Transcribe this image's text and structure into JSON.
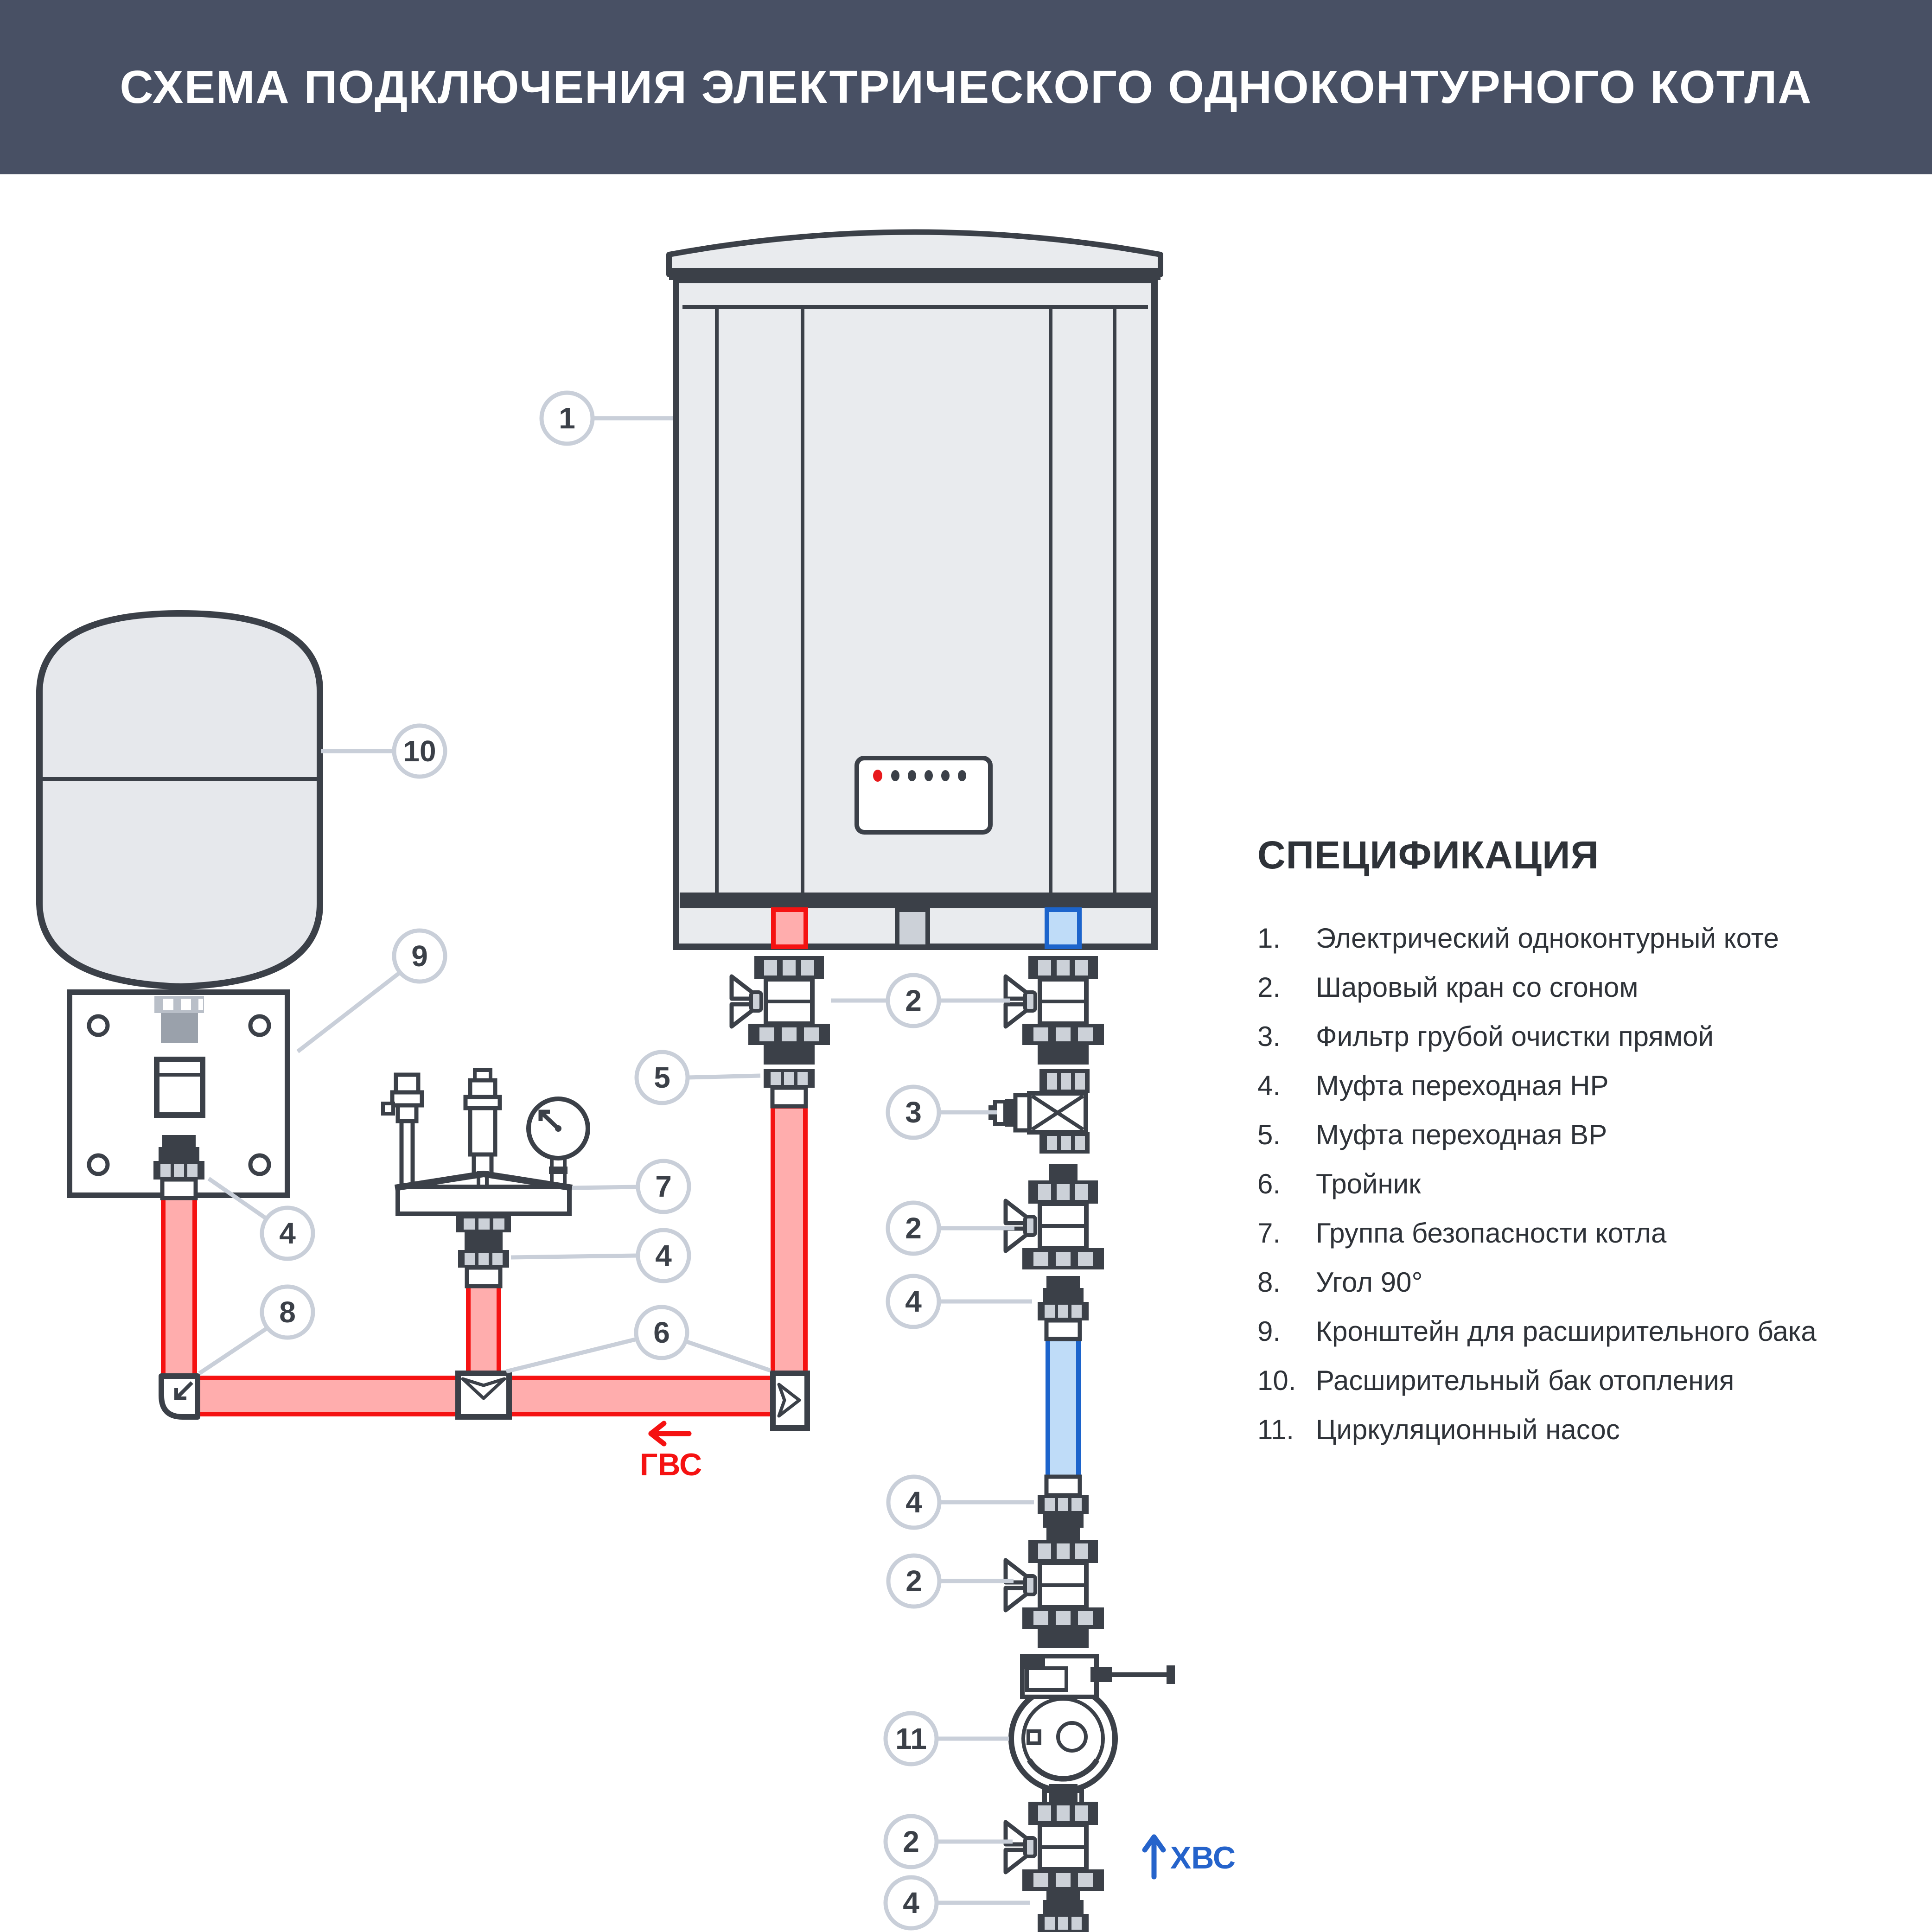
{
  "header": {
    "title": "СХЕМА ПОДКЛЮЧЕНИЯ ЭЛЕКТРИЧЕСКОГО ОДНОКОНТУРНОГО КОТЛА"
  },
  "spec": {
    "heading": "СПЕЦИФИКАЦИЯ",
    "items": [
      {
        "num": "1.",
        "text": "Электрический одноконтурный коте"
      },
      {
        "num": "2.",
        "text": "Шаровый кран со сгоном"
      },
      {
        "num": "3.",
        "text": "Фильтр грубой очистки прямой"
      },
      {
        "num": "4.",
        "text": "Муфта переходная НР"
      },
      {
        "num": "5.",
        "text": "Муфта переходная ВР"
      },
      {
        "num": "6.",
        "text": "Тройник"
      },
      {
        "num": "7.",
        "text": "Группа безопасности котла"
      },
      {
        "num": "8.",
        "text": "Угол 90°"
      },
      {
        "num": "9.",
        "text": "Кронштейн для расширительного бака"
      },
      {
        "num": "10.",
        "text": "Расширительный бак отопления"
      },
      {
        "num": "11.",
        "text": " Циркуляционный насос"
      }
    ]
  },
  "flow": {
    "hot": "ГВС",
    "cold": "ХВС"
  },
  "callouts": {
    "boiler": "1",
    "valve_top": "2",
    "filter": "3",
    "coupling_bracket": "4",
    "coupling_safety": "4",
    "coupling_a": "4",
    "coupling_b": "4",
    "coupling_c": "4",
    "coupling_vr": "5",
    "tee": "6",
    "safety_group": "7",
    "elbow90": "8",
    "bracket": "9",
    "tank": "10",
    "pump": "11",
    "valve_b": "2",
    "valve_c": "2",
    "valve_d": "2"
  },
  "colors": {
    "header_bg": "#485064",
    "outline": "#3b4048",
    "panel": "#e9ebee",
    "hot_stroke": "#f51212",
    "hot_fill": "#ffadad",
    "cold_stroke": "#1c64cc",
    "cold_fill": "#bfdcf8",
    "callout_stroke": "#c9cfd9",
    "led_red": "#e8191c"
  }
}
